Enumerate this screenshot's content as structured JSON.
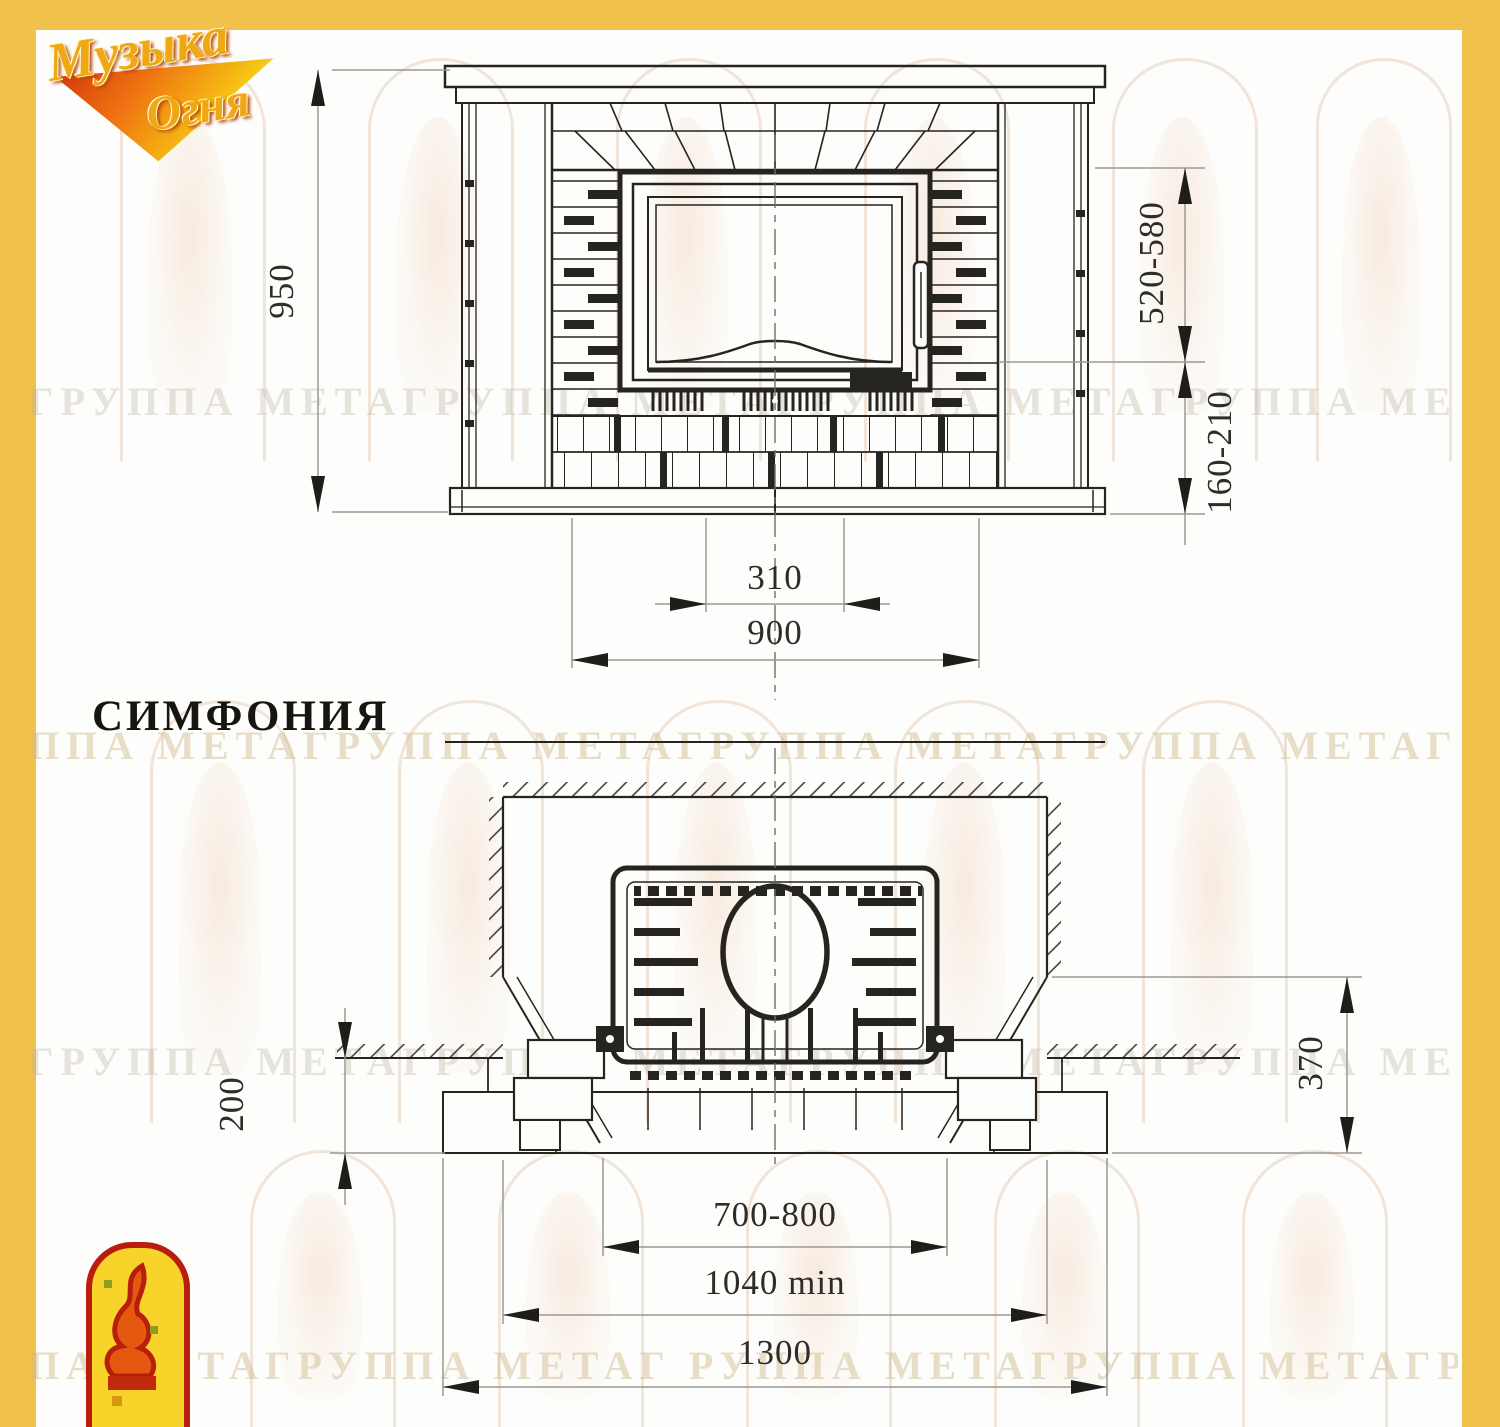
{
  "page": {
    "border_color": "#f1c24b",
    "background": "#fdfdfb"
  },
  "brand": {
    "logo_line1": "Музыка",
    "logo_line2": "Огня"
  },
  "model": {
    "title": "СИМФОНИЯ"
  },
  "watermark": {
    "rows": [
      {
        "text": "ГРУППА МЕТАГРУППА МЕТАГРУППА МЕТАГРУППА МЕТАГРУППА МЕТА"
      },
      {
        "text": "ППА МЕТАГРУППА МЕТАГРУППА МЕТАГРУППА МЕТАГРУППА МЕТАГРУ"
      },
      {
        "text": "ГРУППА МЕТАГРУППА МЕТАГРУППА МЕТАГРУППА МЕТАГРУППА МЕТА"
      },
      {
        "text": "ПА МЕТАГРУППА МЕТАГ РУППА МЕТАГРУППА МЕТАГРУППА МЕТАГРУ"
      }
    ]
  },
  "front_view": {
    "label": "front elevation",
    "dimensions": {
      "overall_height": "950",
      "opening_height": "520-580",
      "plinth_height": "160-210",
      "inner_width": "310",
      "portal_width": "900"
    }
  },
  "plan_view": {
    "label": "plan section",
    "dimensions": {
      "hearth_projection": "200",
      "wall_offset": "370",
      "insert_width": "700-800",
      "niche_width": "1040 min",
      "overall_width": "1300"
    }
  }
}
